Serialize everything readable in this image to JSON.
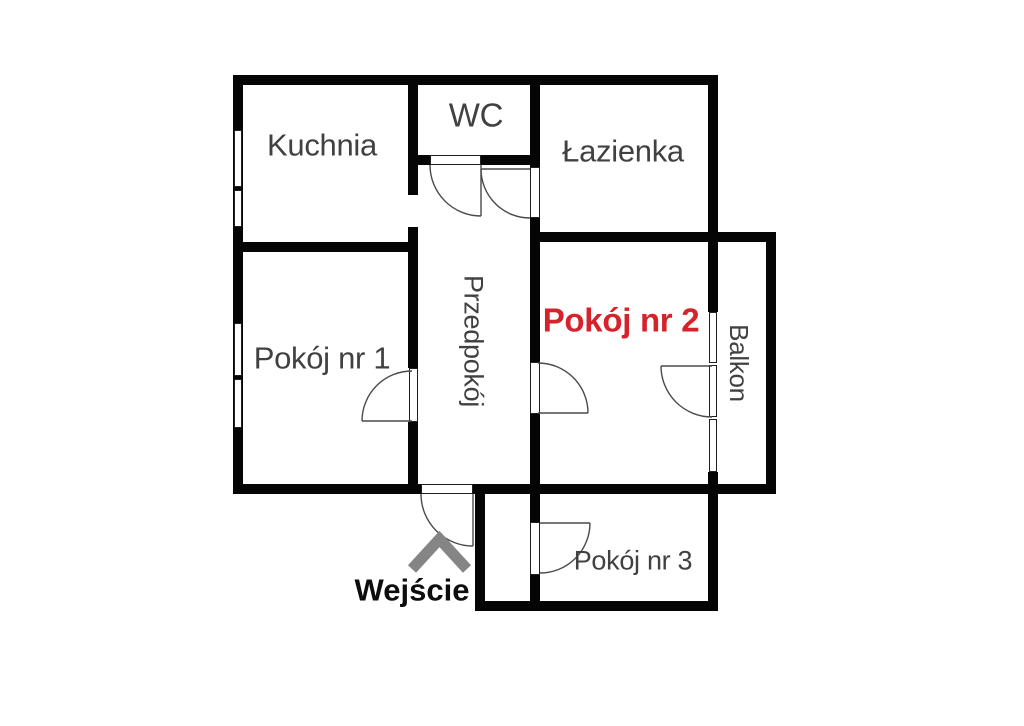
{
  "title": "Apartment floor plan",
  "colors": {
    "wall": "#050505",
    "label": "#414141",
    "accent_red": "#d6222b",
    "arrow_gray": "#858585",
    "background": "#ffffff",
    "door_arc": "#4a4a4a"
  },
  "rooms": {
    "kuchnia": {
      "label": "Kuchnia"
    },
    "wc": {
      "label": "WC"
    },
    "lazienka": {
      "label": "Łazienka"
    },
    "pokoj1": {
      "label": "Pokój nr 1"
    },
    "przedpokoj": {
      "label": "Przedpokój"
    },
    "pokoj2": {
      "label": "Pokój nr 2"
    },
    "balkon": {
      "label": "Balkon"
    },
    "pokoj3": {
      "label": "Pokój nr 3"
    }
  },
  "entrance": {
    "label": "Wejście"
  }
}
